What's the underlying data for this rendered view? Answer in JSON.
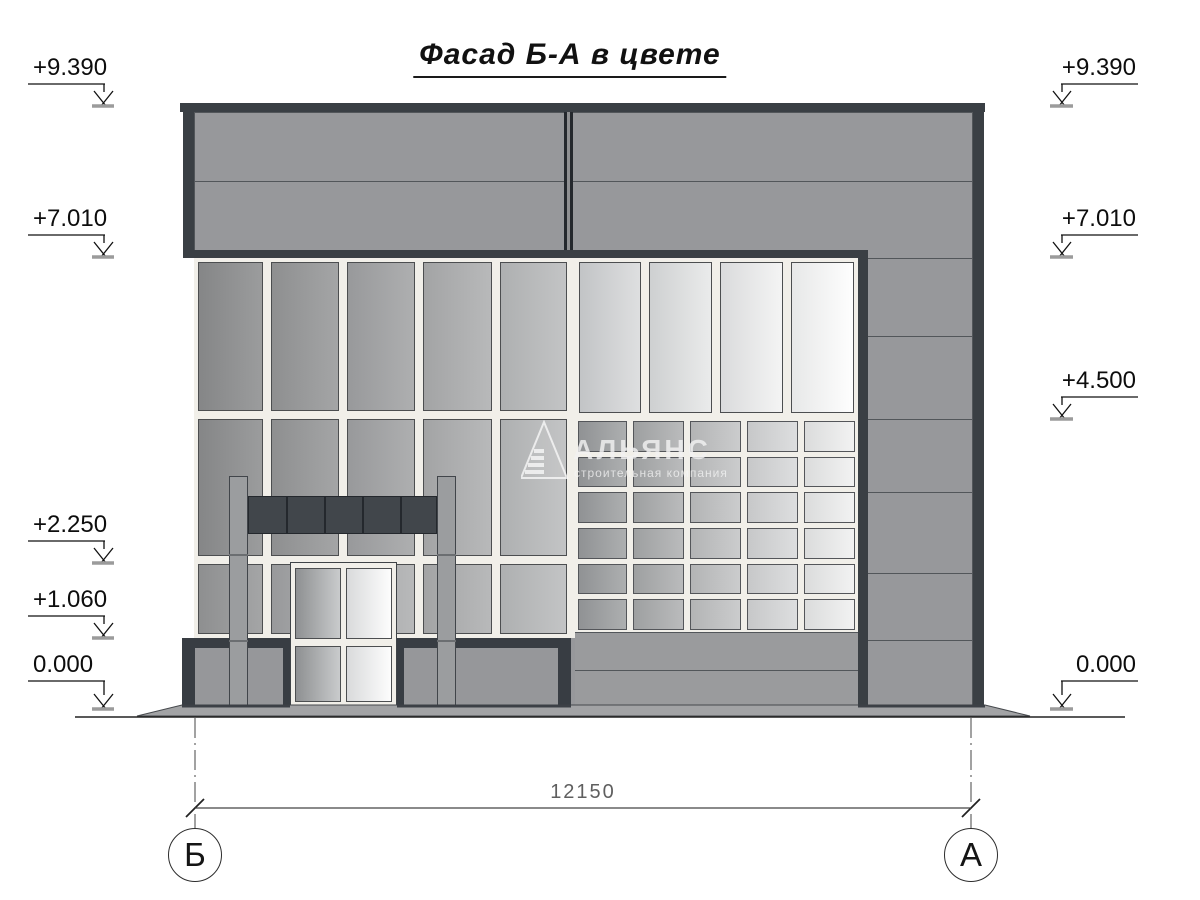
{
  "title": {
    "text": "Фасад Б-А  в цвете"
  },
  "watermark": {
    "name": "АЛЬЯНС",
    "tagline": "строительная компания"
  },
  "dimension": {
    "value": "12150",
    "y": 808,
    "x1": 195,
    "x2": 971
  },
  "axes": {
    "left_label": "Б",
    "right_label": "А",
    "left_x": 195,
    "right_x": 971,
    "circle_y": 855
  },
  "elevations": {
    "left": [
      {
        "label": "+9.390",
        "line_y": 84,
        "tip_y": 104
      },
      {
        "label": "+7.010",
        "line_y": 235,
        "tip_y": 255
      },
      {
        "label": "+2.250",
        "line_y": 541,
        "tip_y": 561
      },
      {
        "label": "+1.060",
        "line_y": 616,
        "tip_y": 636
      },
      {
        "label": "0.000",
        "line_y": 681,
        "tip_y": 707
      }
    ],
    "right": [
      {
        "label": "+9.390",
        "line_y": 84,
        "tip_y": 104
      },
      {
        "label": "+7.010",
        "line_y": 235,
        "tip_y": 255
      },
      {
        "label": "+4.500",
        "line_y": 397,
        "tip_y": 417
      },
      {
        "label": "0.000",
        "line_y": 681,
        "tip_y": 707
      }
    ]
  },
  "ground": {
    "x1": 75,
    "x2": 1125,
    "y": 717
  },
  "slab": {
    "points": "137,716 182,705 985,705 1030,716",
    "dark_segments": [
      [
        182,
        290
      ],
      [
        397,
        571
      ],
      [
        858,
        985
      ]
    ]
  },
  "colors": {
    "dark": "#3a3f44",
    "darker": "#24282d",
    "frame_white": "#f1efe9",
    "body_gray": "#97989b",
    "line": "#52565a",
    "canopy": "#41464b",
    "post": "#9b9d9f",
    "plinth_gray": "#96979a",
    "slab": "#a2a3a5",
    "below_grid": "#9a9b9d"
  },
  "facade": {
    "top_band": {
      "x": 180,
      "y": 103,
      "w": 805,
      "h": 9
    },
    "left_strip": {
      "x": 183,
      "y": 112,
      "w": 11,
      "h": 146
    },
    "body": {
      "x": 194,
      "y": 112,
      "w": 779,
      "h": 594
    },
    "body_hline_y": 181,
    "divider": {
      "x": 564,
      "y": 112,
      "w": 9,
      "h": 138
    },
    "band2": {
      "x": 183,
      "y": 250,
      "w": 685,
      "h": 8
    },
    "wall_backing_left": {
      "x": 194,
      "y": 258,
      "w": 377,
      "h": 380
    },
    "wall_backing_right": {
      "x": 571,
      "y": 258,
      "w": 287,
      "h": 380
    },
    "right_sep_strip": {
      "x": 858,
      "y": 250,
      "w": 10,
      "h": 456
    },
    "right_edge_strip": {
      "x": 973,
      "y": 112,
      "w": 11,
      "h": 594
    },
    "right_col_lines": [
      258,
      336,
      419,
      492,
      573,
      640
    ],
    "right_col_span": {
      "x1": 868,
      "x2": 973
    },
    "left_cols": [
      {
        "x": 198,
        "w": 65
      },
      {
        "x": 271,
        "w": 68
      },
      {
        "x": 347,
        "w": 68
      },
      {
        "x": 423,
        "w": 69
      },
      {
        "x": 500,
        "w": 67
      }
    ],
    "left_rows": [
      {
        "y": 262,
        "h": 149,
        "shades": [
          "l1",
          "l2",
          "l3",
          "l4",
          "l5"
        ]
      },
      {
        "y": 419,
        "h": 137,
        "shades": [
          "l1",
          "l2",
          "l3",
          "l4",
          "l5"
        ]
      },
      {
        "y": 564,
        "h": 70,
        "shades": [
          "l2",
          "l3",
          "l4",
          "l4",
          "l5"
        ]
      }
    ],
    "tall_right": {
      "y": 262,
      "h": 151,
      "cells": [
        {
          "x": 579,
          "w": 62,
          "shade": "r1"
        },
        {
          "x": 649,
          "w": 63,
          "shade": "r2"
        },
        {
          "x": 720,
          "w": 63,
          "shade": "r3"
        },
        {
          "x": 791,
          "w": 63,
          "shade": "r4"
        }
      ]
    },
    "grid_rows": [
      {
        "y": 421,
        "h": 31
      },
      {
        "y": 457,
        "h": 30
      },
      {
        "y": 492,
        "h": 31
      },
      {
        "y": 528,
        "h": 31
      },
      {
        "y": 564,
        "h": 30
      },
      {
        "y": 599,
        "h": 31
      }
    ],
    "grid_cols": [
      {
        "x": 578,
        "w": 49,
        "shade": "g1"
      },
      {
        "x": 633,
        "w": 51,
        "shade": "g2"
      },
      {
        "x": 690,
        "w": 51,
        "shade": "g3"
      },
      {
        "x": 747,
        "w": 51,
        "shade": "g4"
      },
      {
        "x": 804,
        "w": 51,
        "shade": "g5"
      }
    ],
    "below_grid": {
      "x": 575,
      "y": 632,
      "w": 283,
      "h": 74,
      "line_y": 670
    },
    "posts": [
      {
        "x": 229,
        "y": 476,
        "w": 19,
        "h": 232
      },
      {
        "x": 437,
        "y": 476,
        "w": 19,
        "h": 232
      }
    ],
    "post_joints": [
      554,
      640
    ],
    "canopy": {
      "x": 248,
      "y": 496,
      "w": 189,
      "h": 38,
      "dividers": [
        286,
        324,
        362,
        400
      ]
    },
    "door": {
      "x": 290,
      "y": 562,
      "w": 107,
      "h": 144,
      "panels": [
        {
          "x": 295,
          "w": 46,
          "shade": "d1"
        },
        {
          "x": 346,
          "w": 46,
          "shade": "d2"
        }
      ],
      "upper": {
        "y": 568,
        "h": 71
      },
      "lower": {
        "y": 646,
        "h": 56
      }
    },
    "plinths": [
      {
        "x": 182,
        "y": 638,
        "w": 108,
        "h": 70,
        "inner": {
          "x": 195,
          "y": 648,
          "w": 88,
          "h": 60
        }
      },
      {
        "x": 397,
        "y": 638,
        "w": 174,
        "h": 70,
        "inner": {
          "x": 404,
          "y": 648,
          "w": 154,
          "h": 58
        }
      }
    ]
  }
}
